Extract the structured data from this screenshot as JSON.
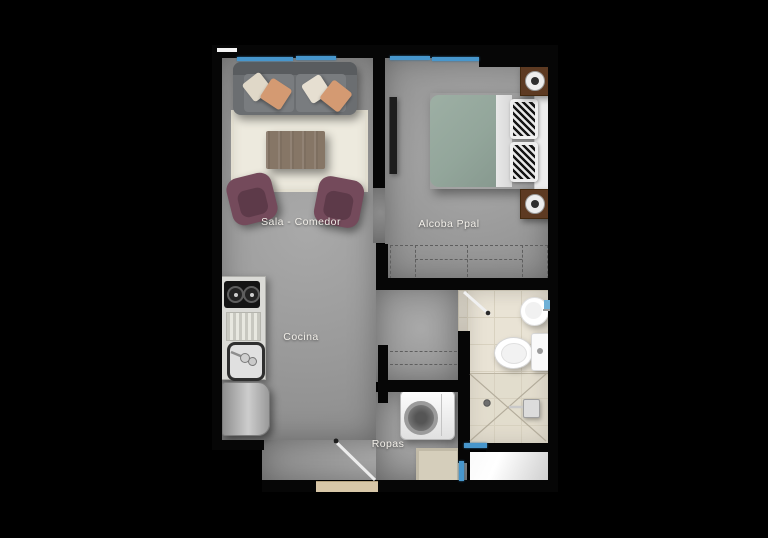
{
  "scene": {
    "type": "apartment-floor-plan",
    "view": "top-down"
  },
  "labels": {
    "sala": "Sala - Comedor",
    "alcoba": "Alcoba Ppal",
    "cocina": "Cocina",
    "ropas": "Ropas"
  },
  "rooms": [
    {
      "id": "sala-comedor",
      "label": "Sala - Comedor",
      "furniture": [
        "sofa",
        "throw-pillows",
        "area-rug",
        "coffee-table",
        "armchair",
        "armchair"
      ]
    },
    {
      "id": "alcoba-ppal",
      "label": "Alcoba Ppal",
      "furniture": [
        "double-bed",
        "headboard",
        "patterned-pillows",
        "nightstand-with-lamp",
        "nightstand-with-lamp",
        "wall-tv",
        "closet-dashed"
      ]
    },
    {
      "id": "cocina",
      "label": "Cocina",
      "furniture": [
        "two-burner-stove",
        "drainboard",
        "kitchen-sink",
        "refrigerator"
      ]
    },
    {
      "id": "ropas",
      "label": "Ropas",
      "furniture": [
        "washing-machine",
        "floor-mat",
        "closet-dashed"
      ]
    },
    {
      "id": "bathroom",
      "label": "",
      "furniture": [
        "toilet",
        "round-sink",
        "shower-with-drain",
        "swing-door"
      ]
    }
  ],
  "openings": {
    "entrance_door": "diagonal-swing-bottom-center",
    "bathroom_door": "diagonal-swing-top-left",
    "bedroom_doorway": "open",
    "windows_top": 4,
    "windows_bottom": 2
  },
  "colors": {
    "background": "#000000",
    "wall": "#060606",
    "floor_gray": "#9a9a9a",
    "floor_bath": "#e9e3d5",
    "window_glass": "#4796cc",
    "rug": "#edeade",
    "sofa": "#6b6e71",
    "pillow_cream": "#e0d8c8",
    "pillow_tan": "#d49a72",
    "armchair": "#744a5b",
    "coffee_table": "#867666",
    "bed_duvet": "#95a89d",
    "nightstand": "#5d3a22",
    "label_text": "#f2efe9"
  }
}
